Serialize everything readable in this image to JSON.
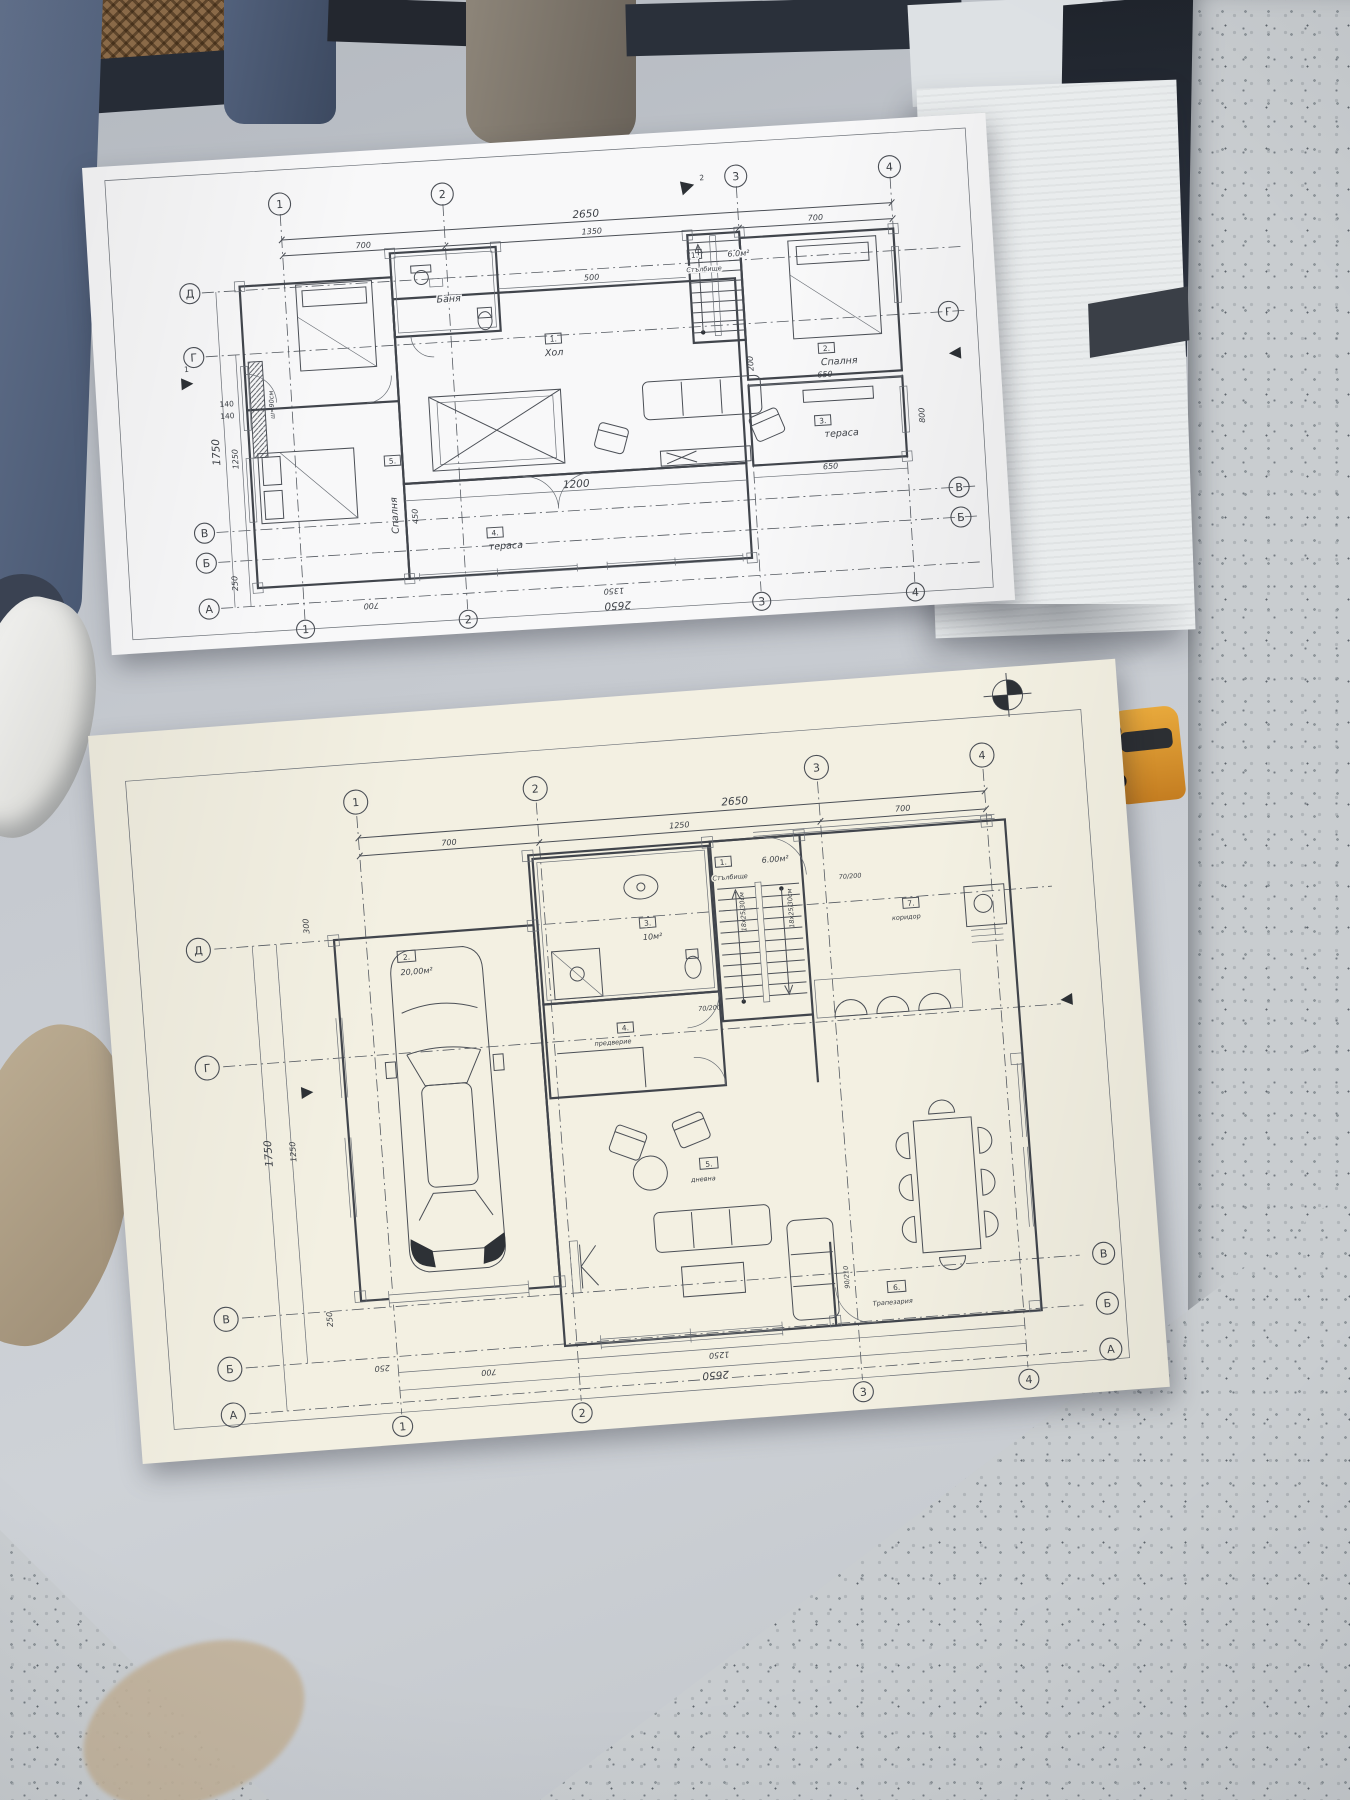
{
  "scene": {
    "colors": {
      "table": "#c6cad0",
      "paper_top": "#f8f8f9",
      "paper_bottom": "#f3f0e2",
      "ink": "#44484f",
      "foam": "#e9eced",
      "navy": "#2a303a",
      "jeans": "#5c6b86",
      "cane": "#8a6a48",
      "toy_car": "#e8a93c",
      "floor": "#c9cdd0"
    }
  },
  "sheet_top": {
    "axes": {
      "cols": [
        "1",
        "2",
        "3",
        "4"
      ],
      "rows_left": [
        "Д",
        "Г",
        "В",
        "Б",
        "А"
      ],
      "rows_right": [
        "Г",
        "В",
        "Б"
      ]
    },
    "dims": {
      "d2650": "2650",
      "d1350": "1350",
      "d700l": "700",
      "d700r": "700",
      "d500": "500",
      "d1200": "1200",
      "d650a": "650",
      "d650b": "650",
      "d450": "450",
      "d200": "200",
      "d800": "800",
      "d1750": "1750",
      "d1250": "1250",
      "d140a": "140",
      "d140b": "140",
      "d250": "250",
      "note_w": "ш=90см",
      "b2650": "2650",
      "b1350": "1350",
      "b700": "700"
    },
    "rooms": {
      "hall": {
        "tag": "1.",
        "name": "Хол"
      },
      "bedroom2": {
        "tag": "2.",
        "name": "Спалня"
      },
      "terrace3": {
        "tag": "3.",
        "name": "тераса"
      },
      "terrace4": {
        "tag": "4.",
        "name": "тераса"
      },
      "bedroom5": {
        "tag": "5.",
        "name": "Спалня"
      },
      "bath": {
        "name": "Баня"
      },
      "stairs": {
        "tag": "1.",
        "name": "Стълбище",
        "area": "6.0м²"
      }
    },
    "marks": [
      "1",
      "2"
    ]
  },
  "sheet_bottom": {
    "axes": {
      "cols": [
        "1",
        "2",
        "3",
        "4"
      ],
      "rows_left": [
        "Д",
        "Г",
        "В",
        "Б",
        "А"
      ],
      "rows_right": [
        "В",
        "Б",
        "А"
      ]
    },
    "dims": {
      "d2650": "2650",
      "d1250": "1250",
      "d700l": "700",
      "d700r": "700",
      "d1750": "1750",
      "d1250v": "1250",
      "d300": "300",
      "d250": "250",
      "b2650": "2650",
      "b1250": "1250",
      "b700": "700",
      "b250": "250",
      "door70": "70/200",
      "door90": "90/210"
    },
    "stair_note": "18х25/30см",
    "rooms": {
      "stairs": {
        "tag": "1.",
        "name": "Стълбище",
        "area": "6.00м²"
      },
      "garage": {
        "tag": "2.",
        "area": "20,00м²"
      },
      "bath": {
        "tag": "3.",
        "area": "10м²"
      },
      "entry": {
        "tag": "4.",
        "name": "предверие"
      },
      "living": {
        "tag": "5.",
        "name": "дневна"
      },
      "dining": {
        "tag": "6.",
        "name": "Трапезария"
      },
      "corridor": {
        "tag": "7.",
        "name": "коридор"
      }
    }
  }
}
